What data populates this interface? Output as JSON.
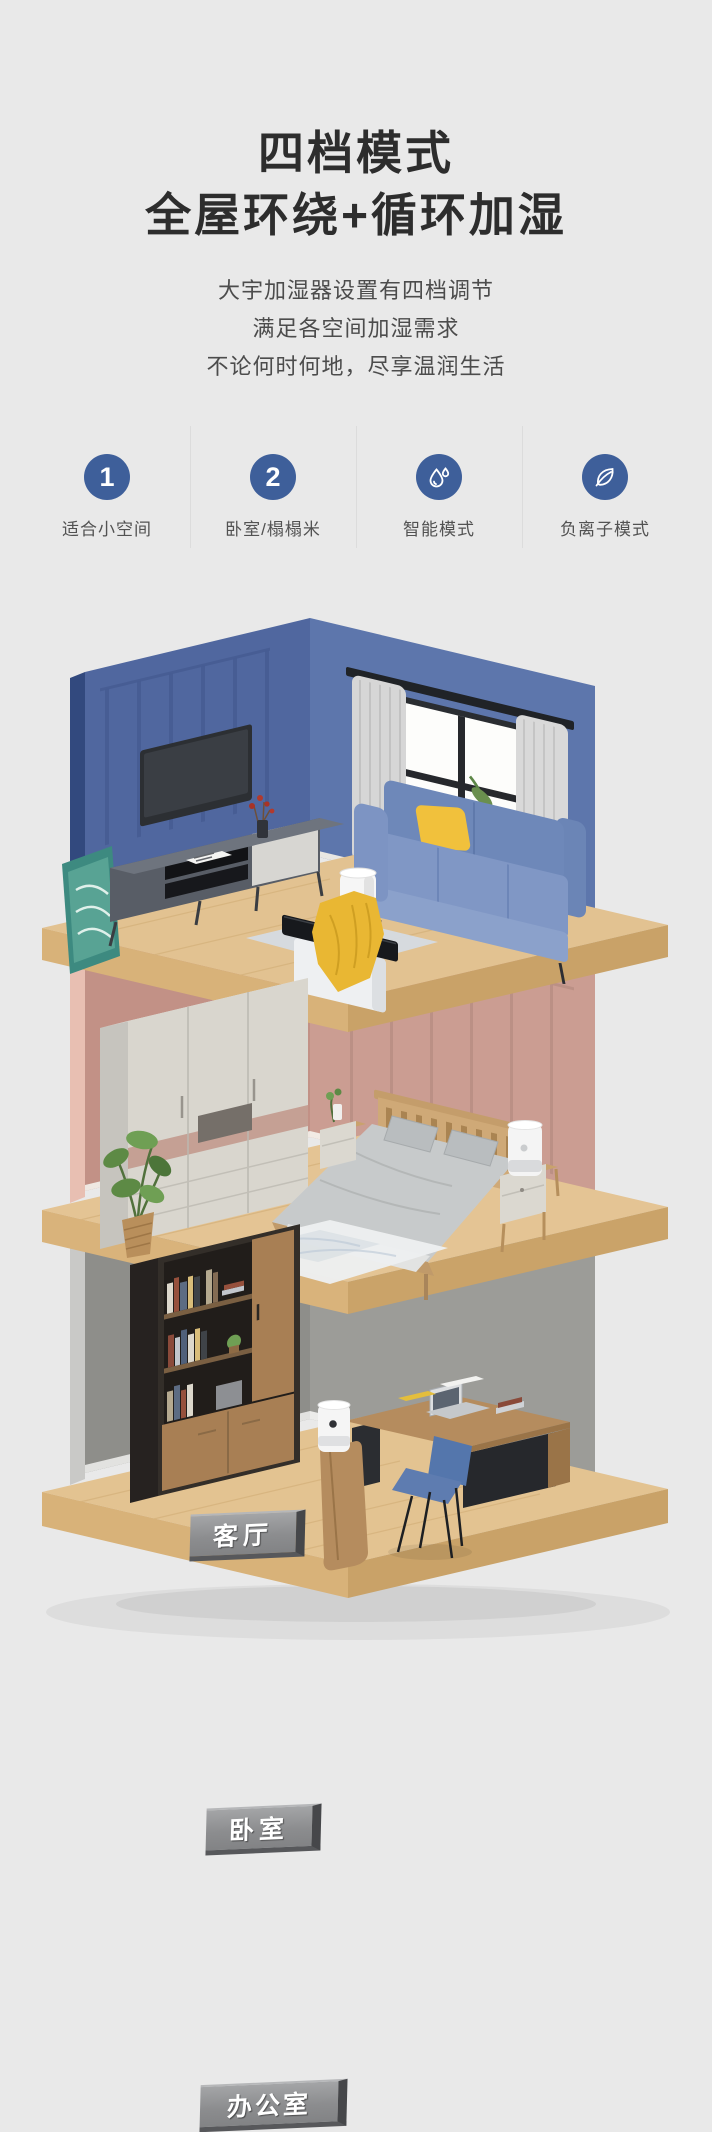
{
  "page": {
    "background": "#e9e9e9"
  },
  "header": {
    "title_line1": "四档模式",
    "title_line2": "全屋环绕+循环加湿",
    "subtitle_line1": "大宇加湿器设置有四档调节",
    "subtitle_line2": "满足各空间加湿需求",
    "subtitle_line3": "不论何时何地，尽享温润生活"
  },
  "features": {
    "accent_color": "#3e5f9a",
    "items": [
      {
        "icon": "badge-1-icon",
        "glyph": "1",
        "label": "适合小空间"
      },
      {
        "icon": "badge-2-icon",
        "glyph": "2",
        "label": "卧室/榻榻米"
      },
      {
        "icon": "water-drop-icon",
        "label": "智能模式"
      },
      {
        "icon": "leaf-icon",
        "label": "负离子模式"
      }
    ]
  },
  "illustration": {
    "type": "isometric-three-floor-home-cutaway",
    "floors": [
      {
        "name": "living-room",
        "label": "客厅",
        "wall_color": "#5d76ac"
      },
      {
        "name": "bedroom",
        "label": "卧室",
        "wall_color": "#cb9d92"
      },
      {
        "name": "office",
        "label": "办公室",
        "wall_color": "#9c9c98"
      }
    ],
    "floor_wood_color": "#e2c291"
  }
}
